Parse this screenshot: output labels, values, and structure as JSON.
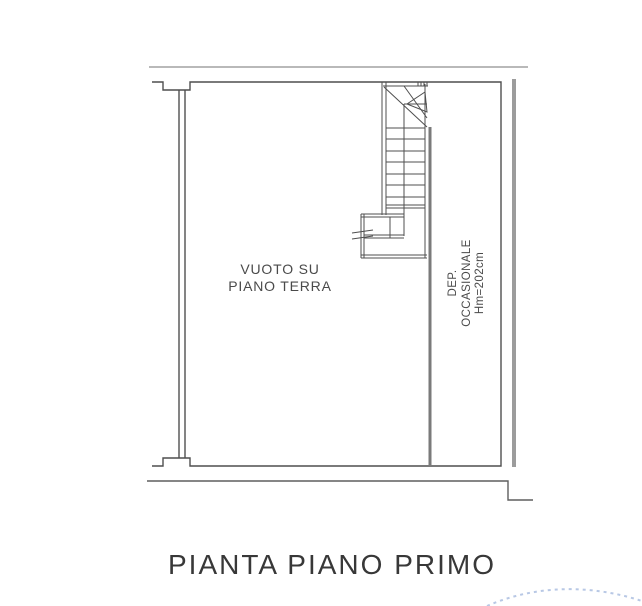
{
  "drawing": {
    "title": "PIANTA PIANO PRIMO",
    "room_labels": {
      "void": {
        "line1": "VUOTO SU",
        "line2": "PIANO TERRA"
      },
      "dep": {
        "line1": "DEP.",
        "line2": "OCCASIONALE",
        "line3": "Hm=202cm"
      }
    },
    "annotations": {
      "dep_height_value": "Hm=202cm"
    }
  },
  "icons": {
    "stair_direction_arrow": "arrow-up-along-stairs"
  },
  "colors": {
    "line": "#4f4f4f",
    "line-light": "#8f8f8f",
    "wall-thick": "#9c9c9c",
    "partition": "#7a7a7a",
    "lower": "#5f5f5f",
    "text": "#4a4a4a",
    "title": "#383838",
    "watermark": "#7d9ad0",
    "bg": "#ffffff"
  }
}
